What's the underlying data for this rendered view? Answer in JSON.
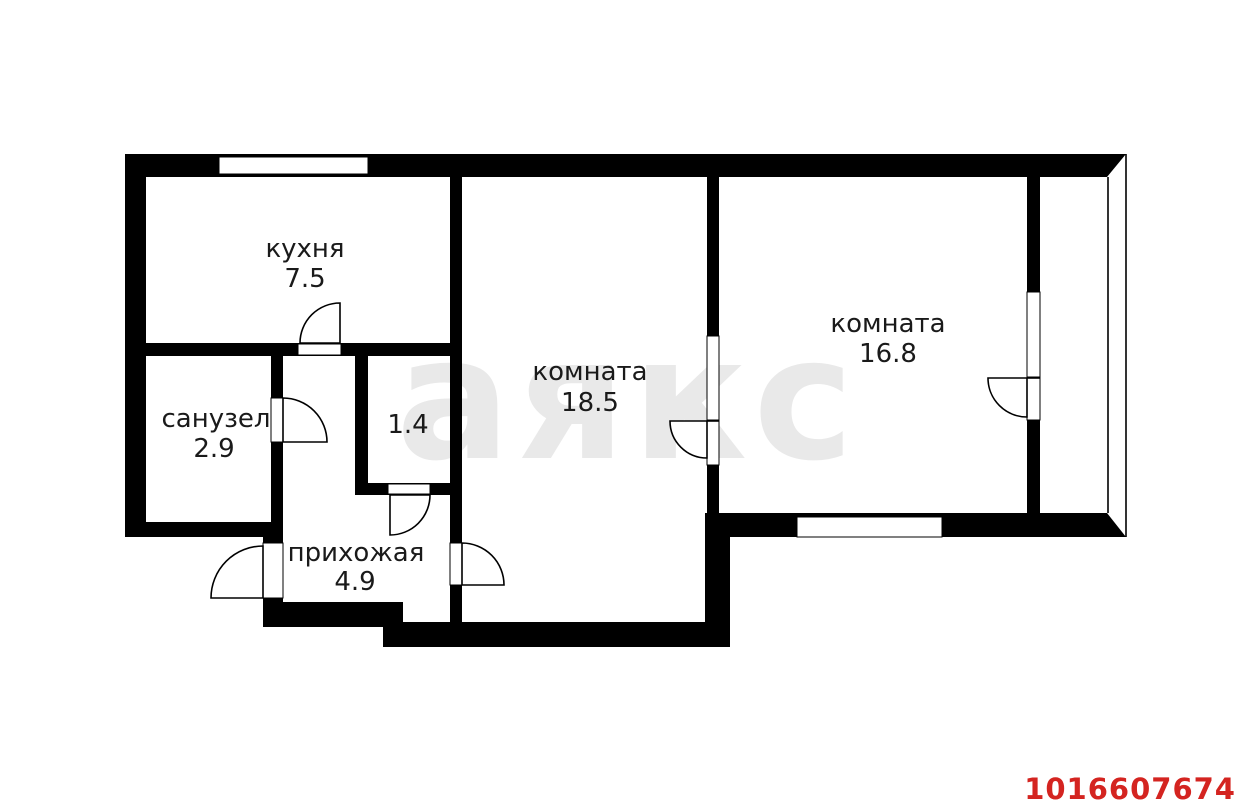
{
  "plan": {
    "watermark": {
      "text": "аякс",
      "color": "#e9e9e9"
    },
    "listing_id": {
      "text": "1016607674",
      "color": "#d42420"
    },
    "colors": {
      "wall": "#000000",
      "floor": "#ffffff",
      "label": "#1a1a1a"
    },
    "rooms": [
      {
        "name": "кухня",
        "area": "7.5"
      },
      {
        "name": "санузел",
        "area": "2.9"
      },
      {
        "name": "",
        "area": "1.4"
      },
      {
        "name": "прихожая",
        "area": "4.9"
      },
      {
        "name": "комната",
        "area": "18.5"
      },
      {
        "name": "комната",
        "area": "16.8"
      }
    ]
  }
}
